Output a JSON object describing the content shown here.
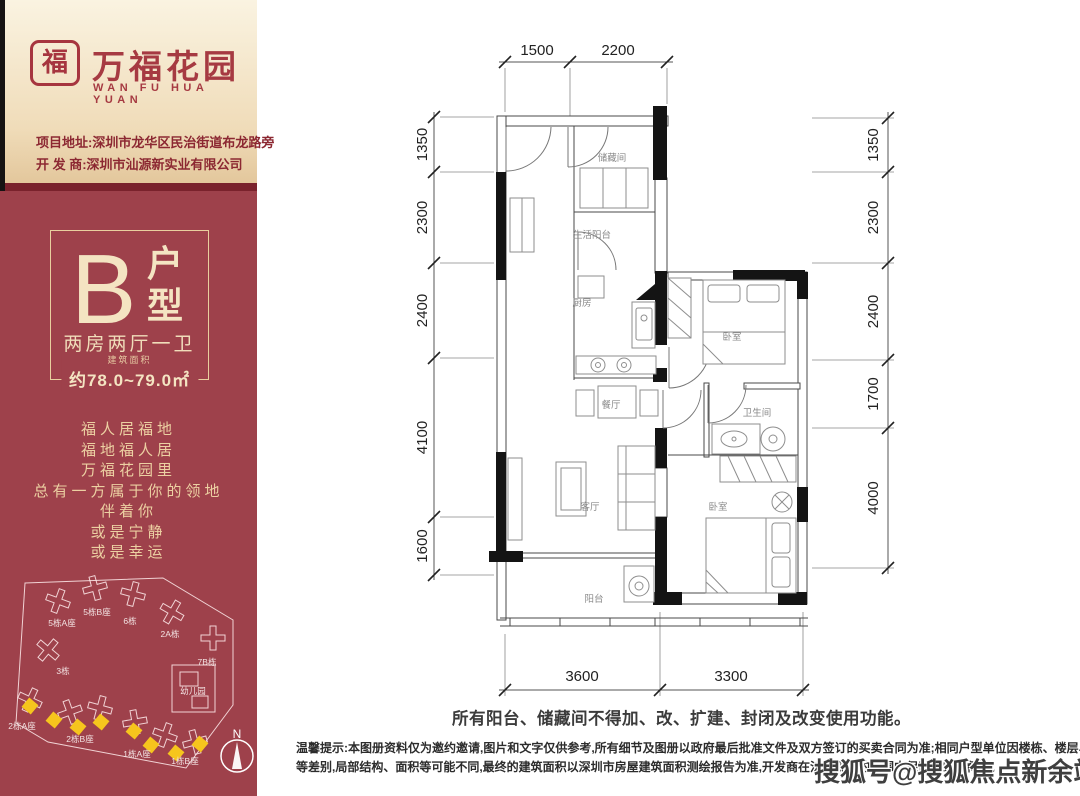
{
  "brand": {
    "seal_char": "福",
    "name": "万福花园",
    "name_en": "WAN FU HUA YUAN",
    "address_line": "项目地址:深圳市龙华区民治街道布龙路旁",
    "developer_line": "开 发 商:深圳市汕源新实业有限公司"
  },
  "unit": {
    "letter": "B",
    "type": [
      "户",
      "型"
    ],
    "layout": "两房两厅一卫",
    "area_label": "建筑面积",
    "area_value": "约78.0~79.0㎡"
  },
  "poem": {
    "lines": [
      "福人居福地",
      "福地福人居",
      "万福花园里",
      "总有一方属于你的领地",
      "伴着你",
      "或是宁静",
      "或是幸运"
    ]
  },
  "site_map": {
    "buildings": [
      "5栋A座",
      "5栋B座",
      "6栋",
      "2A栋",
      "7B栋",
      "3栋",
      "幼儿园",
      "2栋A座",
      "2栋B座",
      "1栋A座",
      "1栋B座"
    ],
    "compass_label": "N",
    "highlight_color": "#f6c51d"
  },
  "floor_plan": {
    "rooms": [
      "储藏间",
      "生活阳台",
      "厨房",
      "卧室",
      "餐厅",
      "卫生间",
      "客厅",
      "卧室",
      "阳台"
    ],
    "dimensions": {
      "top": [
        "1500",
        "2200"
      ],
      "left": [
        "1350",
        "2300",
        "2400",
        "4100",
        "1600"
      ],
      "right": [
        "1350",
        "2300",
        "2400",
        "1700",
        "4000"
      ],
      "bottom": [
        "3600",
        "3300"
      ]
    }
  },
  "notices": {
    "usage": "所有阳台、储藏间不得加、改、扩建、封闭及改变使用功能。",
    "tip_label": "温馨提示:",
    "tip_line1": "本图册资料仅为邀约邀请,图片和文字仅供参考,所有细节及图册以政府最后批准文件及双方签订的买卖合同为准;相同户型单位因楼栋、楼层、单元",
    "tip_line2": "等差别,局部结构、面积等可能不同,最终的建筑面积以深圳市房屋建筑面积测绘报告为准,开发商在法律规定的范围内保留最终解释权。"
  },
  "watermark": {
    "text": "搜狐号@搜狐焦点新余站"
  },
  "colors": {
    "sidebar_red": "#9e414b",
    "brand_red": "#a63a42",
    "gold_text": "#ecd0a2",
    "highlight_yellow": "#f6c51d"
  }
}
